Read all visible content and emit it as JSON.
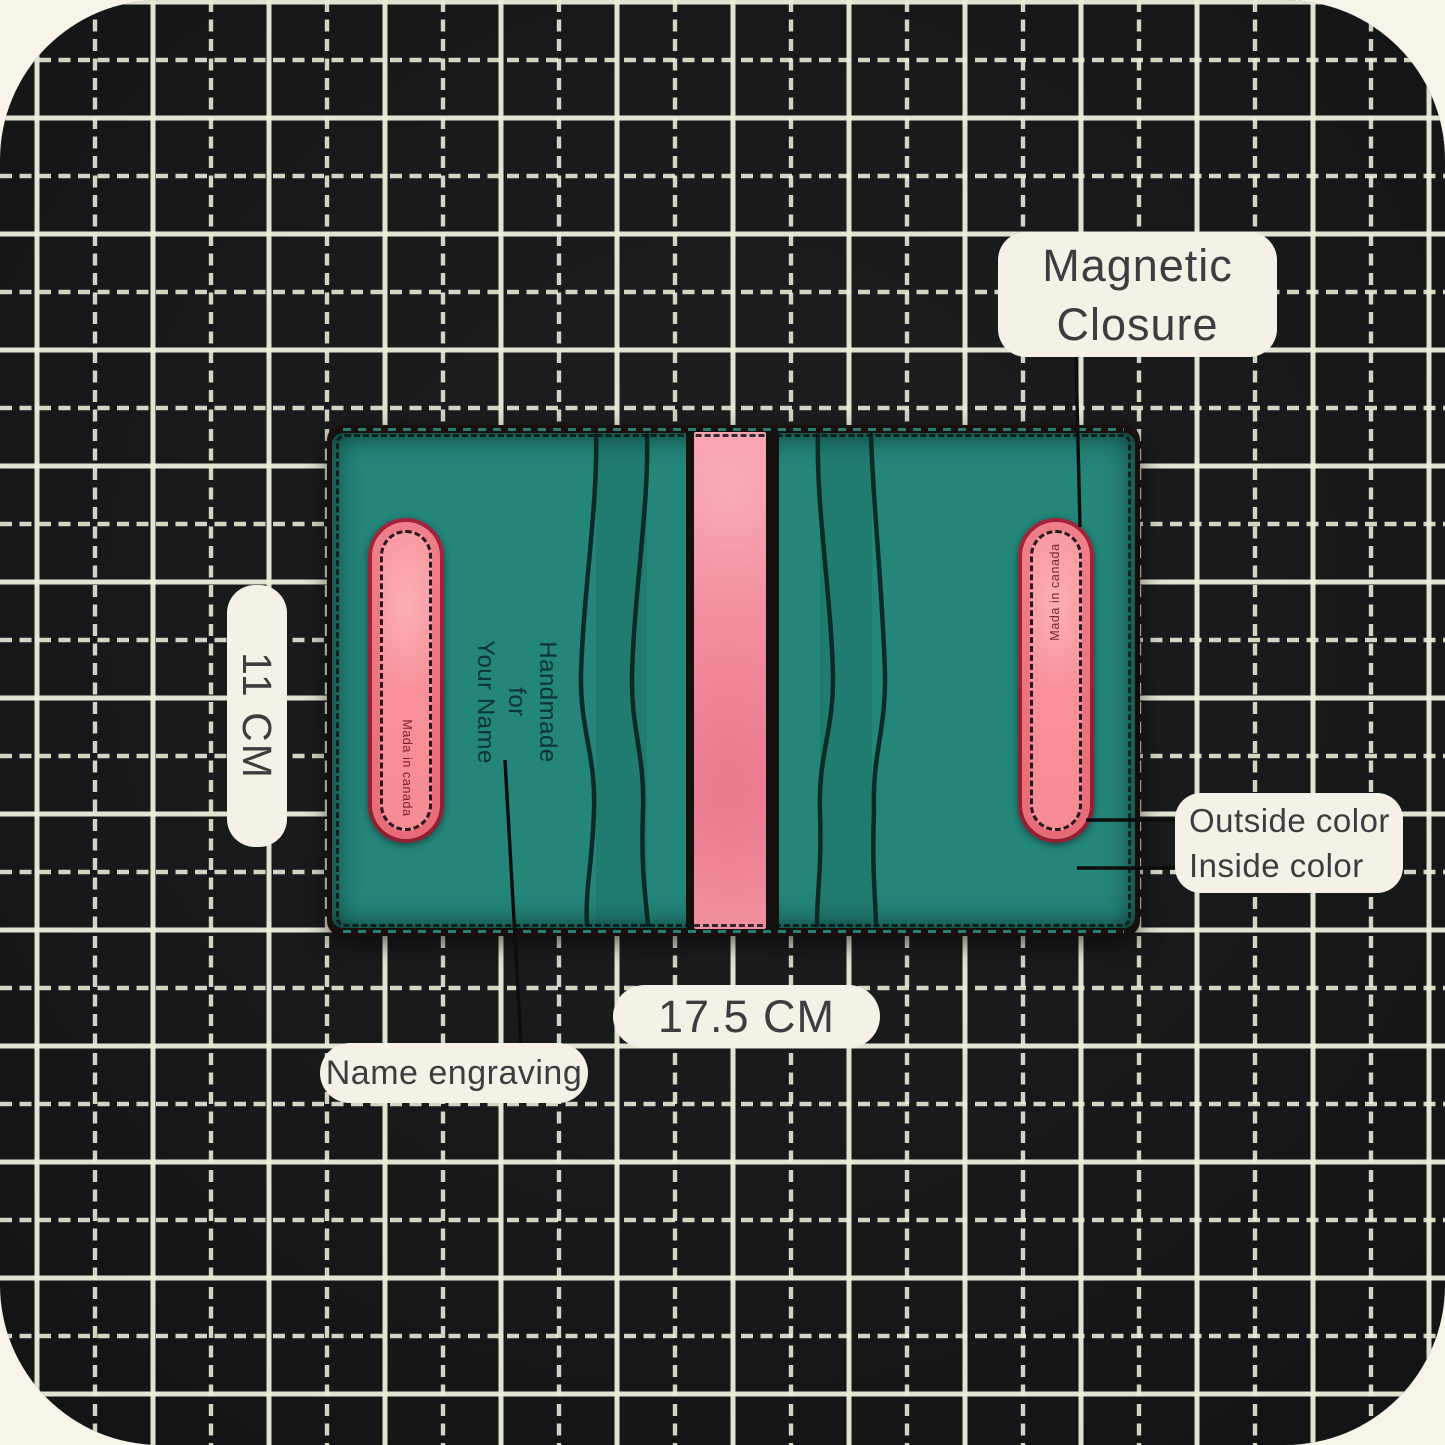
{
  "annotations": {
    "magnetic_closure": {
      "line1": "Magnetic",
      "line2": "Closure"
    },
    "height_label": "11 CM",
    "width_label": "17.5 CM",
    "name_engraving": "Name engraving",
    "outside_color": "Outside color",
    "inside_color": "Inside color"
  },
  "wallet": {
    "engraving": {
      "line1": "Handmade",
      "line2": "for",
      "line3": "Your Name"
    },
    "made_in_left": "Mada in canada",
    "made_in_right": "Mada in canada",
    "colors": {
      "inside_leather_teal": "#248579",
      "outside_leather_pink": "#f18a9c",
      "strip_edge_red": "#a3243a",
      "edge_black": "#140d0c"
    }
  },
  "scene": {
    "background_color": "#f8f4ea",
    "mat_color": "#18191b",
    "grid_line_color": "#edeeda",
    "label_background": "#f6f1e7",
    "label_text_color": "#3d3d40",
    "pointer_line_color": "#0d0d0d"
  }
}
